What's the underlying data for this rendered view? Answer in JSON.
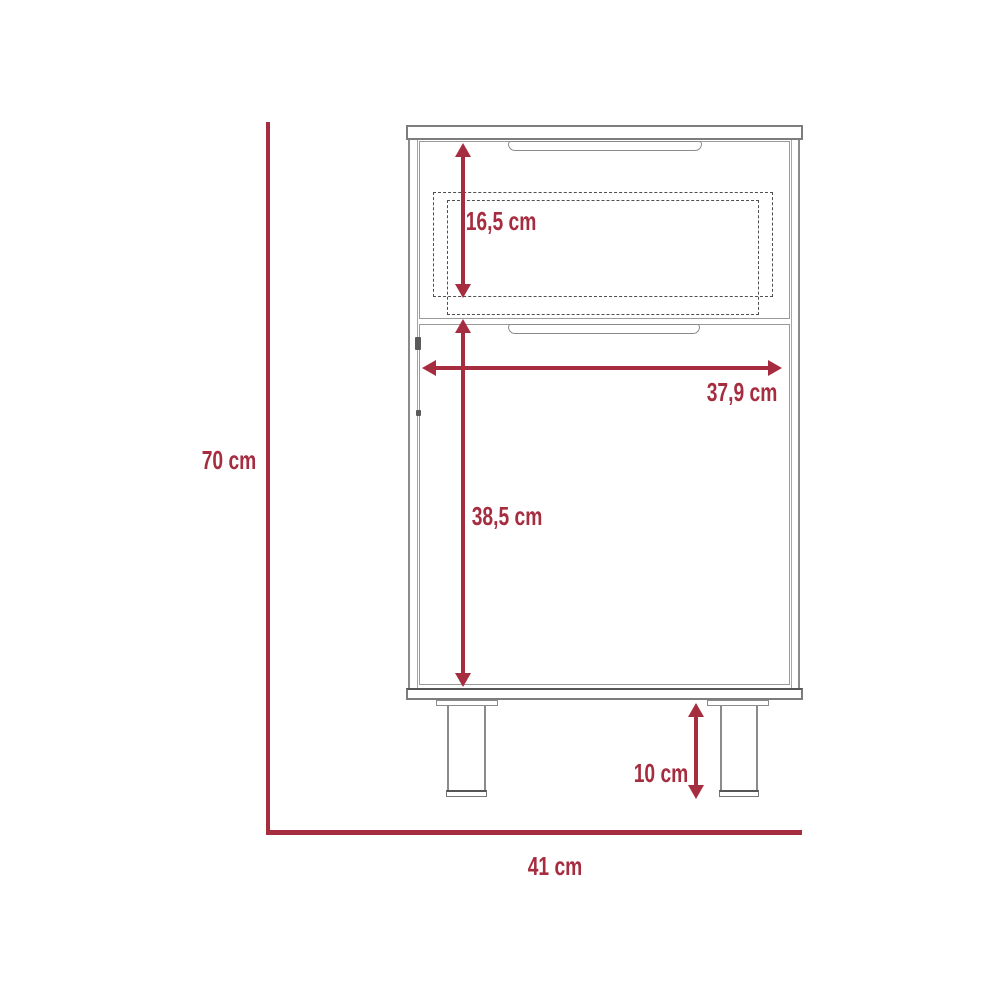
{
  "colors": {
    "accent": "#A62C3F",
    "line": "#8b8b8b",
    "dashed": "#4f4f4f"
  },
  "dimensions": {
    "overall_height": {
      "label": "70 cm"
    },
    "overall_width": {
      "label": "41 cm"
    },
    "drawer_height": {
      "label": "16,5 cm"
    },
    "interior_width": {
      "label": "37,9 cm"
    },
    "door_height": {
      "label": "38,5 cm"
    },
    "leg_height": {
      "label": "10 cm"
    }
  }
}
